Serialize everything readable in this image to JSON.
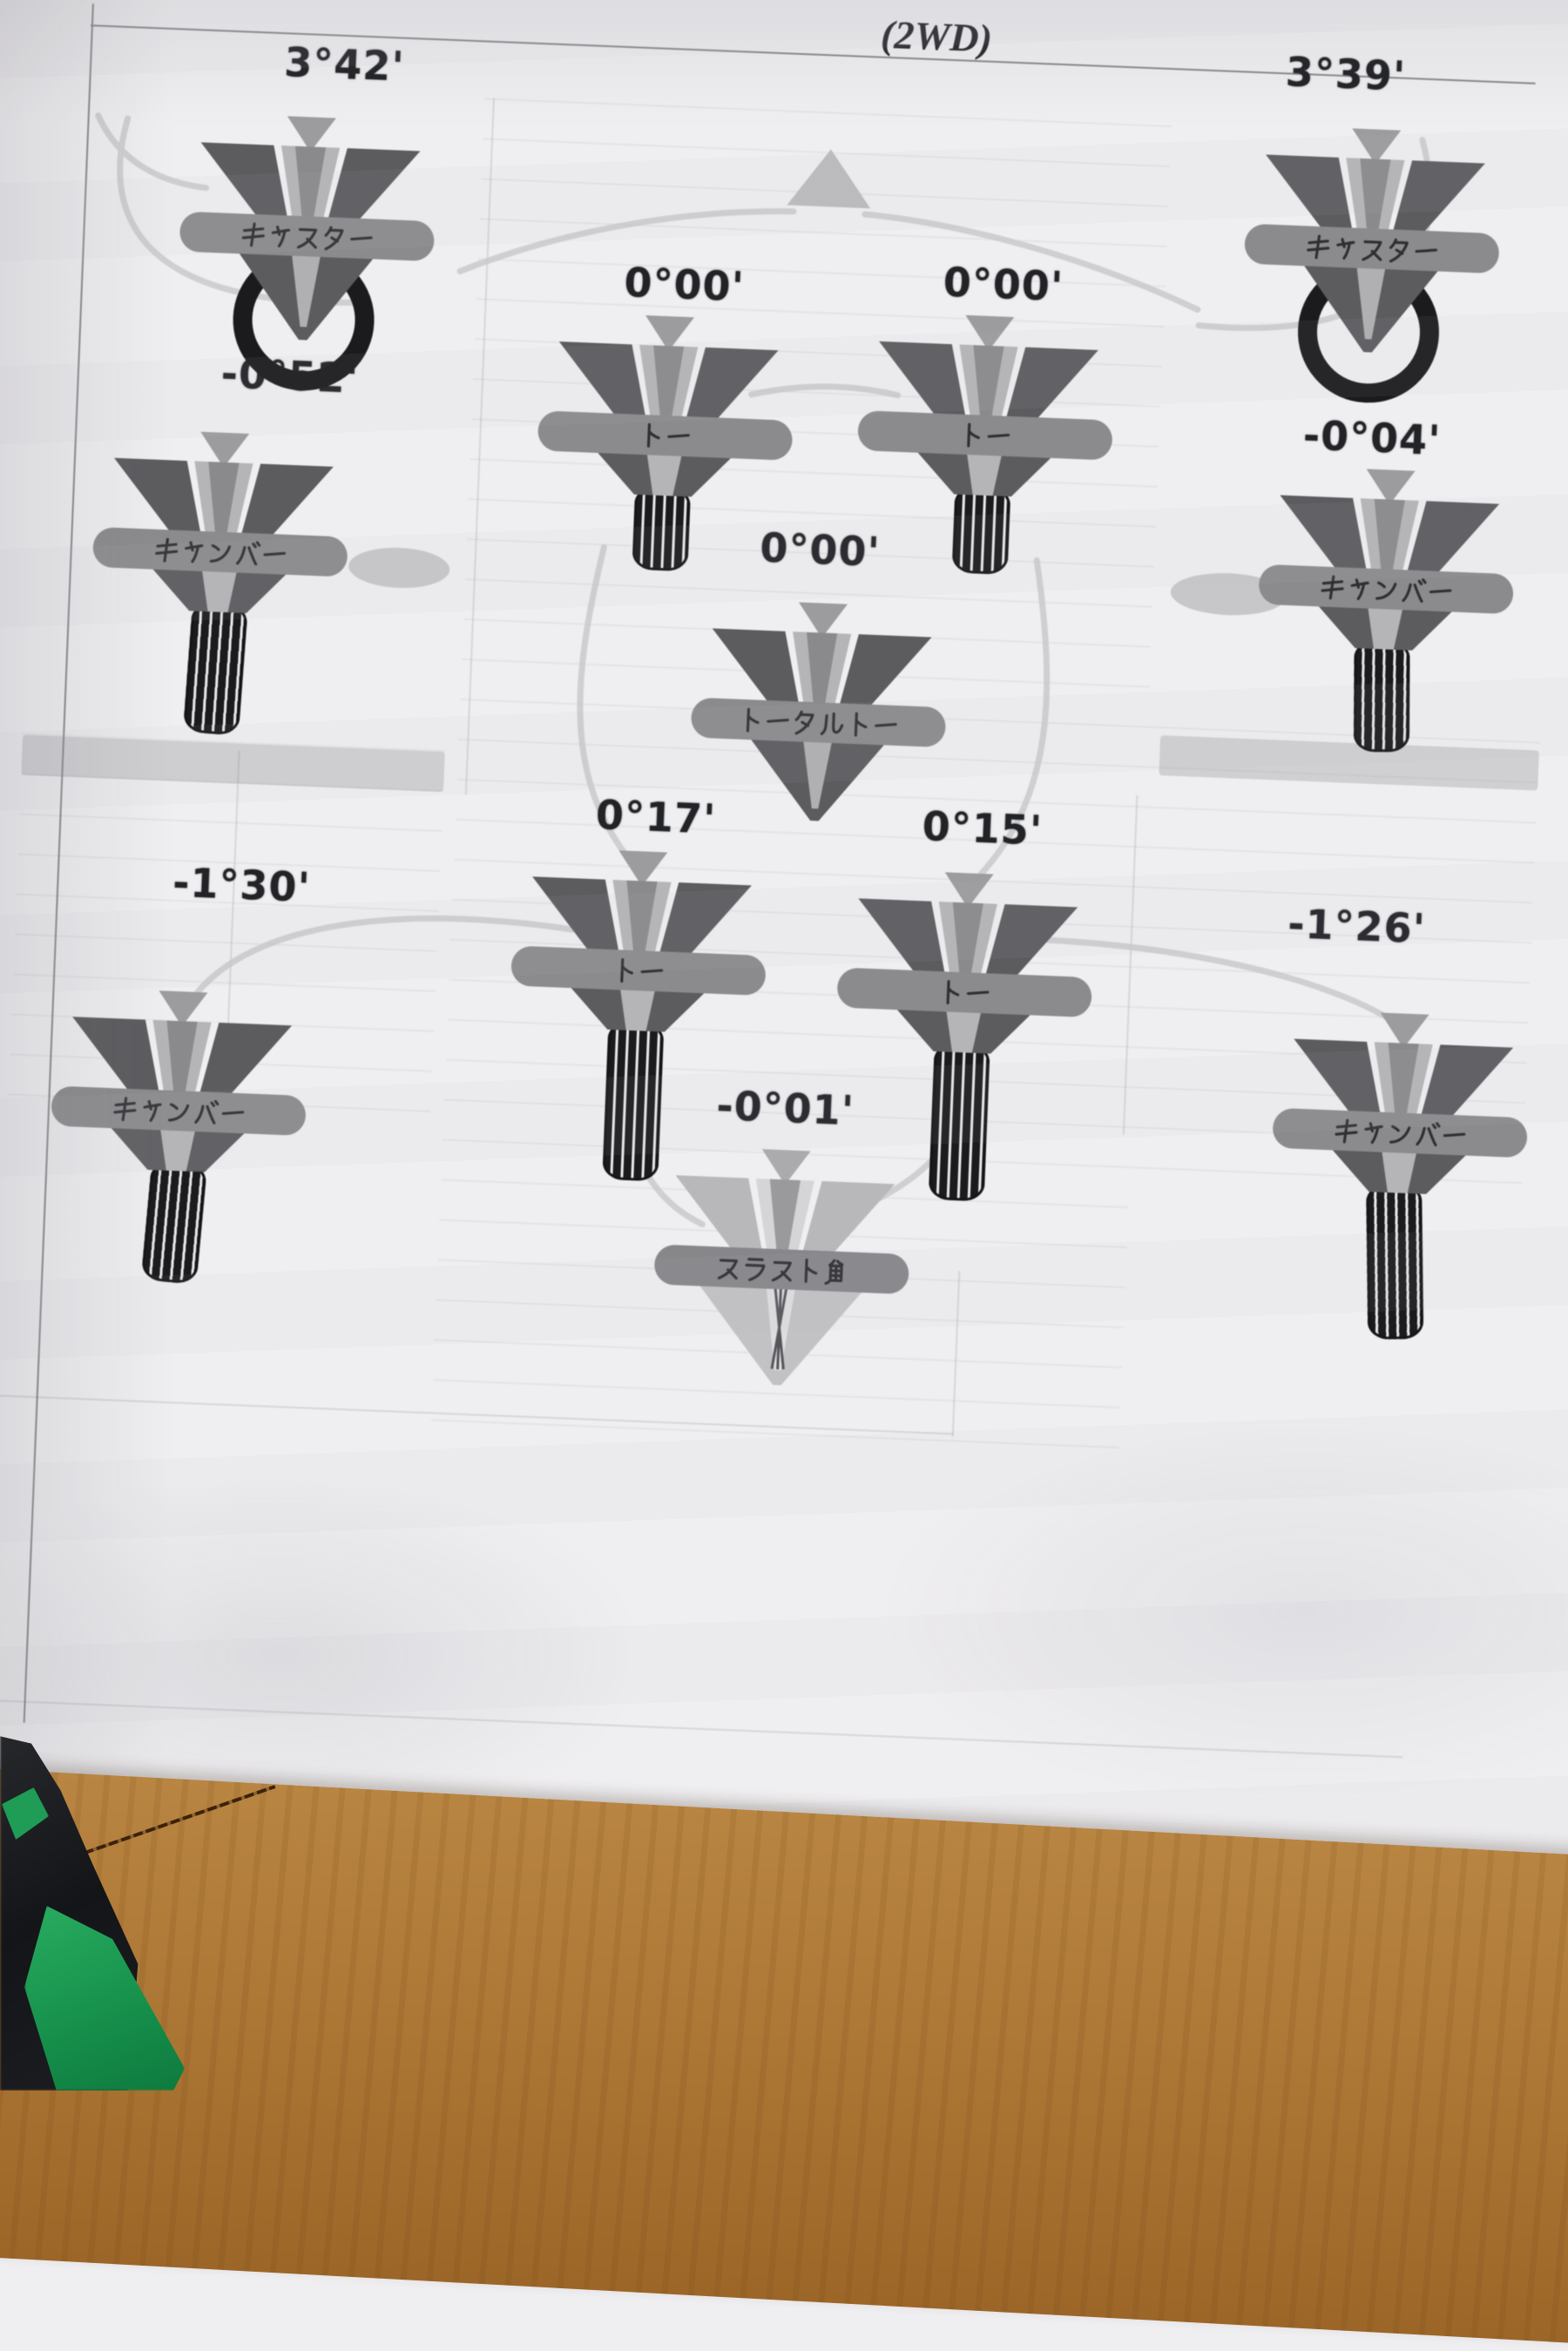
{
  "document": {
    "header_fragment": "(2WD)",
    "labels": {
      "caster": "キャスター",
      "camber": "キャンバー",
      "toe": "トー",
      "total_toe": "トータルトー",
      "thrust_angle": "スラスト角"
    },
    "values": {
      "front_left_caster": "3°42'",
      "front_right_caster": "3°39'",
      "front_left_camber": "-0°52'",
      "front_right_camber": "-0°04'",
      "front_left_toe": "0°00'",
      "front_right_toe": "0°00'",
      "total_toe": "0°00'",
      "rear_left_toe": "0°17'",
      "rear_right_toe": "0°15'",
      "rear_left_camber": "-1°30'",
      "rear_right_camber": "-1°26'",
      "thrust_angle": "-0°01'"
    },
    "colors": {
      "paper": "#efeef0",
      "gauge_dark": "#5c5c5f",
      "gauge_bar": "#8b8b8d",
      "gauge_pointer": "#9c9c9e",
      "tire_black": "#1b1b1e",
      "value_text": "#222327",
      "wood_table": "#ad7735",
      "foreground_object_green": "#1f9c55",
      "foreground_object_black": "#141518"
    }
  }
}
